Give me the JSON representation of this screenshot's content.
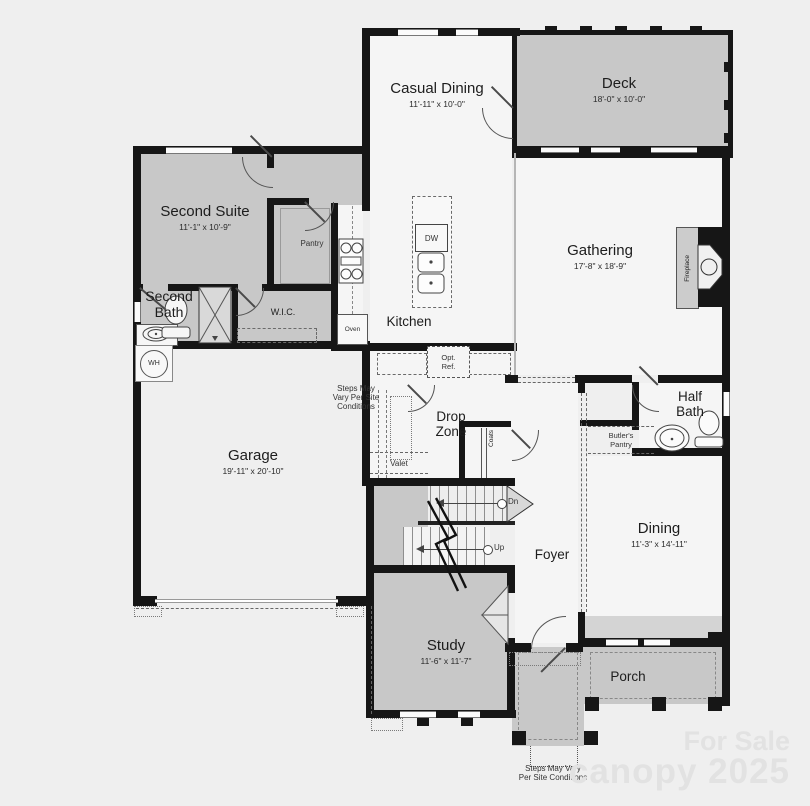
{
  "plan": {
    "rooms": {
      "casual_dining": {
        "label": "Casual Dining",
        "dims": "11'-11\" x 10'-0\""
      },
      "deck": {
        "label": "Deck",
        "dims": "18'-0\" x 10'-0\""
      },
      "second_suite": {
        "label": "Second Suite",
        "dims": "11'-1\" x 10'-9\""
      },
      "gathering": {
        "label": "Gathering",
        "dims": "17'-8\" x 18'-9\""
      },
      "pantry": {
        "label": "Pantry"
      },
      "second_bath": {
        "line1": "Second",
        "line2": "Bath"
      },
      "wic": {
        "label": "W.I.C."
      },
      "kitchen": {
        "label": "Kitchen"
      },
      "garage": {
        "label": "Garage",
        "dims": "19'-11\" x 20'-10\""
      },
      "drop_zone": {
        "line1": "Drop",
        "line2": "Zone"
      },
      "half_bath": {
        "line1": "Half",
        "line2": "Bath"
      },
      "butlers_pantry": {
        "line1": "Butler's",
        "line2": "Pantry"
      },
      "dining": {
        "label": "Dining",
        "dims": "11'-3\" x 14'-11\""
      },
      "foyer": {
        "label": "Foyer"
      },
      "study": {
        "label": "Study",
        "dims": "11'-6\" x 11'-7\""
      },
      "porch": {
        "label": "Porch"
      }
    },
    "fixtures": {
      "fireplace": "Fireplace",
      "dw": "DW",
      "oven": "Oven",
      "opt_ref_line1": "Opt.",
      "opt_ref_line2": "Ref.",
      "valet": "Valet",
      "coats": "Coats",
      "wh": "WH",
      "dn": "Dn",
      "up": "Up"
    },
    "notes": {
      "side": [
        "Steps May",
        "Vary Per Site",
        "Conditions"
      ],
      "bottom": [
        "Steps May Vary",
        "Per Site Conditions"
      ]
    },
    "watermark": {
      "line1": "For Sale",
      "line2": "canopy 2025"
    },
    "colors": {
      "wall": "#161616",
      "floor": "#f5f5f5",
      "gray_fill": "#c8c8c8",
      "background": "#efefef"
    }
  }
}
